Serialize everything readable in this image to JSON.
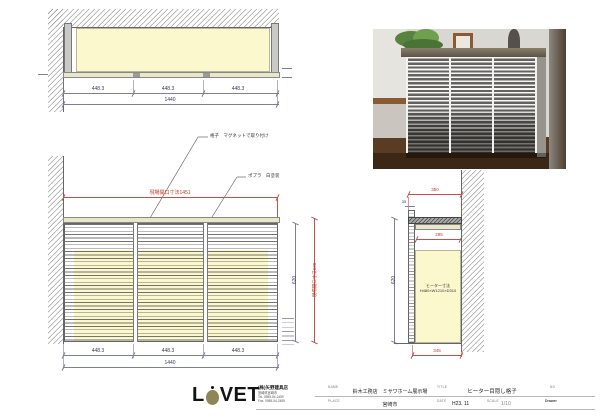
{
  "colors": {
    "dim_red": "#c0392b",
    "dim_blue": "#5f5f8a",
    "fill_yellow": "#fbf8cd",
    "fill_beige": "#eae6c9",
    "logo_olive": "#8d8655"
  },
  "plan": {
    "seg_dims": [
      "448.3",
      "448.3",
      "448.3"
    ],
    "total_dim": "1440"
  },
  "elevation": {
    "leader_lattice": "格子　マグネットで取り付け",
    "leader_material": "ポプラ　白塗装",
    "opening_width": "現場開口寸法1451",
    "opening_height": "現場開口寸法630",
    "body_height": "620",
    "seg_dims": [
      "448.3",
      "448.3",
      "448.3"
    ],
    "total_dim": "1440"
  },
  "section": {
    "top_width": "350",
    "slat_offset": "35",
    "inner_width": "295",
    "bottom_width": "345",
    "height": "620",
    "heater_line1": "ヒーター寸法",
    "heater_line2": "H480×W1210×D310"
  },
  "title_block": {
    "logo_l": "L",
    "logo_tail": "VET",
    "company_name": "(株)矢野建具店",
    "company_address": "宮崎県宮崎市",
    "company_tel": "Tel. 0985-54-2459",
    "company_fax": "Fax. 0985-54-2459",
    "name_label": "NAME",
    "name_value": "鈴木工務店　ミサワホーム展示場",
    "place_label": "PLACE",
    "place_value": "宮崎市",
    "title_label": "TITLE",
    "title_value": "ヒーター目隠し格子",
    "date_label": "DATE",
    "date_value": "H23. 11",
    "scale_label": "SCALE",
    "scale_value": "1/10",
    "no_label": "NO",
    "drawer_label": "Drawer"
  }
}
